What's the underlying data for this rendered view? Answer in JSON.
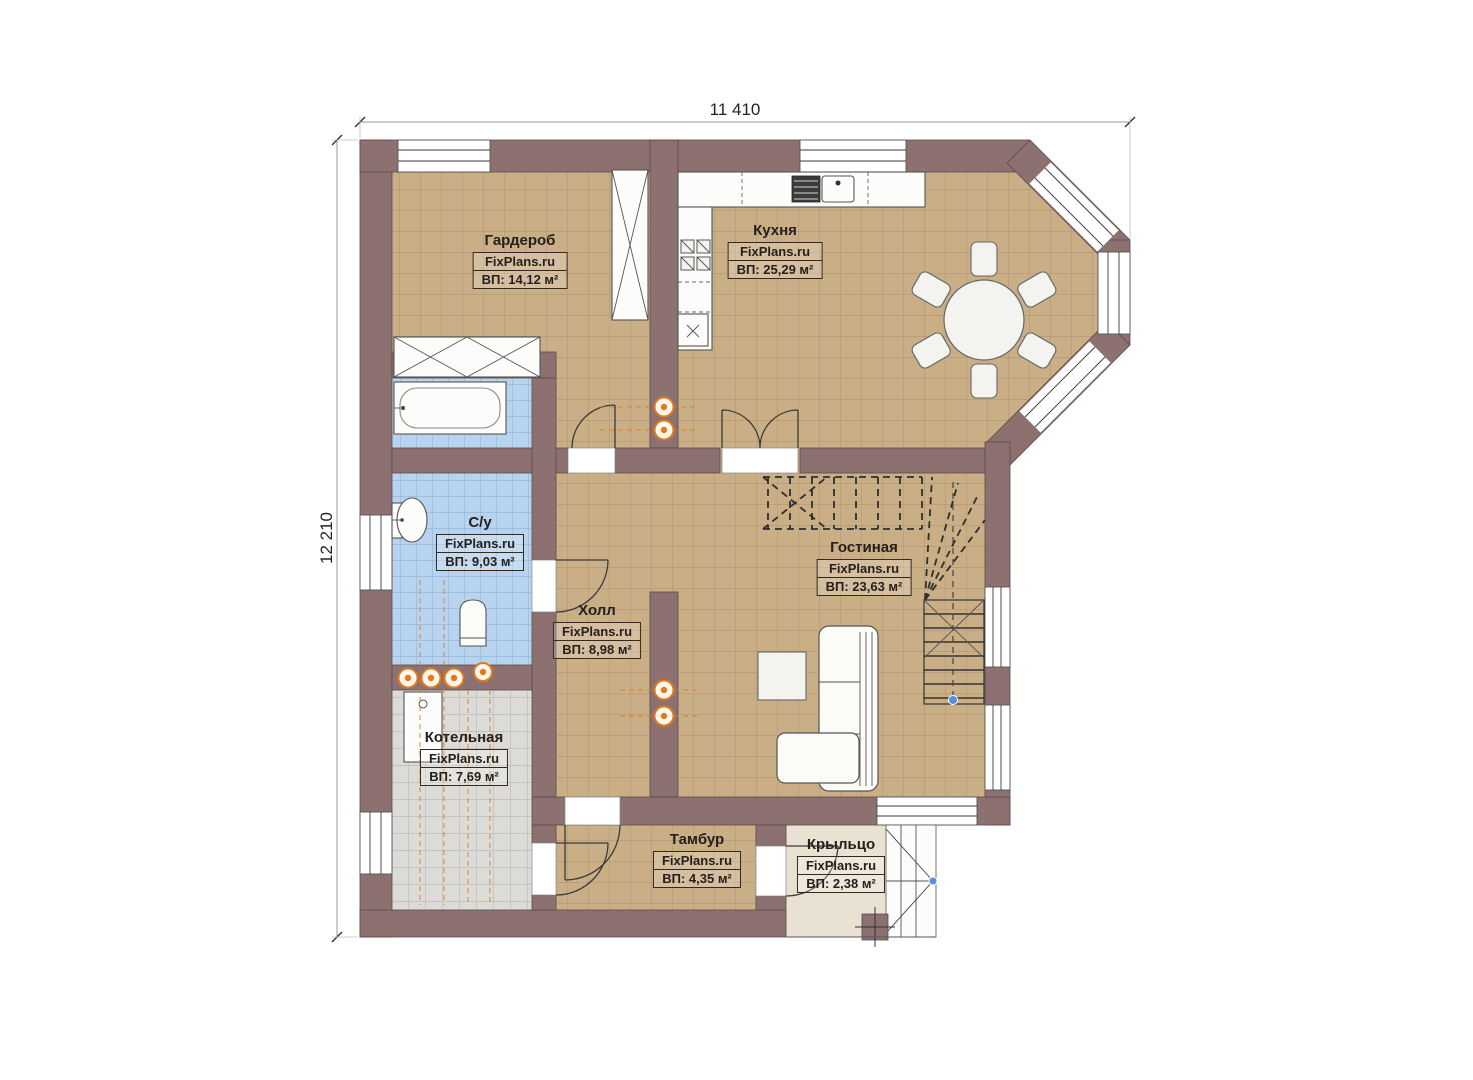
{
  "plan": {
    "dimensions": {
      "width": "11 410",
      "height": "12 210"
    },
    "rooms": [
      {
        "id": "wardrobe",
        "name": "Гардероб",
        "brand": "FixPlans.ru",
        "area": "ВП: 14,12 м²",
        "label_x": 520,
        "label_y": 232
      },
      {
        "id": "kitchen",
        "name": "Кухня",
        "brand": "FixPlans.ru",
        "area": "ВП: 25,29 м²",
        "label_x": 775,
        "label_y": 222
      },
      {
        "id": "bathroom",
        "name": "С/у",
        "brand": "FixPlans.ru",
        "area": "ВП: 9,03 м²",
        "label_x": 480,
        "label_y": 514
      },
      {
        "id": "hall",
        "name": "Холл",
        "brand": "FixPlans.ru",
        "area": "ВП: 8,98 м²",
        "label_x": 597,
        "label_y": 602
      },
      {
        "id": "living",
        "name": "Гостиная",
        "brand": "FixPlans.ru",
        "area": "ВП: 23,63 м²",
        "label_x": 864,
        "label_y": 539
      },
      {
        "id": "boiler",
        "name": "Котельная",
        "brand": "FixPlans.ru",
        "area": "ВП: 7,69 м²",
        "label_x": 464,
        "label_y": 729
      },
      {
        "id": "tambour",
        "name": "Тамбур",
        "brand": "FixPlans.ru",
        "area": "ВП: 4,35 м²",
        "label_x": 697,
        "label_y": 831
      },
      {
        "id": "porch",
        "name": "Крыльцо",
        "brand": "FixPlans.ru",
        "area": "ВП: 2,38 м²",
        "label_x": 841,
        "label_y": 836
      }
    ],
    "colors": {
      "wall": "#8c7170",
      "floor_tile": "#c9ae86",
      "bathroom_tile": "#b7d3ee",
      "boiler_tile": "#dcdbd8",
      "porch_floor": "#e9e1d2",
      "heating_accent": "#e07a1e",
      "marker_blue": "#5b8dd9"
    }
  }
}
